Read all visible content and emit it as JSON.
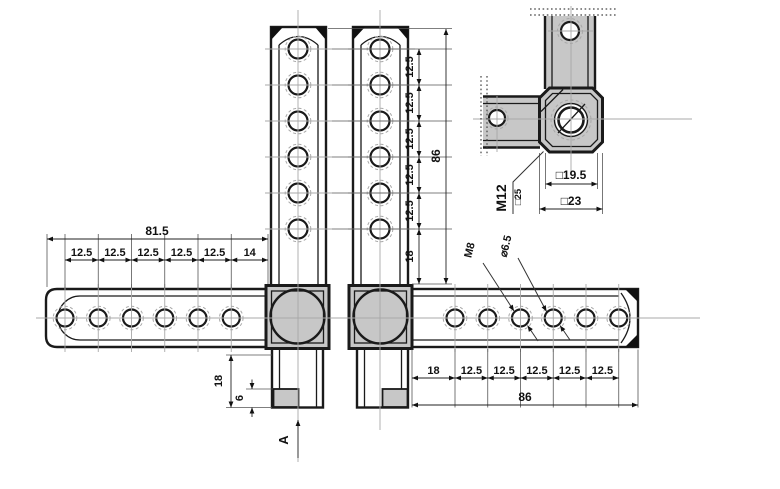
{
  "colors": {
    "metal_fill": "#c7c7c7",
    "outline": "#1a1a1a",
    "centerline": "#a8a8a8",
    "dimension": "#222222",
    "background": "#ffffff"
  },
  "dims": {
    "overall_left": "81.5",
    "left_chain": [
      "12.5",
      "12.5",
      "12.5",
      "12.5",
      "12.5",
      "14"
    ],
    "overall_vertical": "86",
    "vertical_chain": [
      "12.5",
      "12.5",
      "12.5",
      "12.5",
      "12.5",
      "18"
    ],
    "overall_bottom": "86",
    "bottom_chain": [
      "18",
      "12.5",
      "12.5",
      "12.5",
      "12.5",
      "12.5"
    ],
    "tab_height": "18",
    "tab_foot_height": "6"
  },
  "callouts": {
    "thread_small": "M8",
    "hole_diameter": "⌀6.5",
    "thread_main": "M12",
    "square_boss": "□25",
    "square_inner": "□19.5",
    "square_outer": "□23"
  },
  "section": {
    "label": "A"
  }
}
